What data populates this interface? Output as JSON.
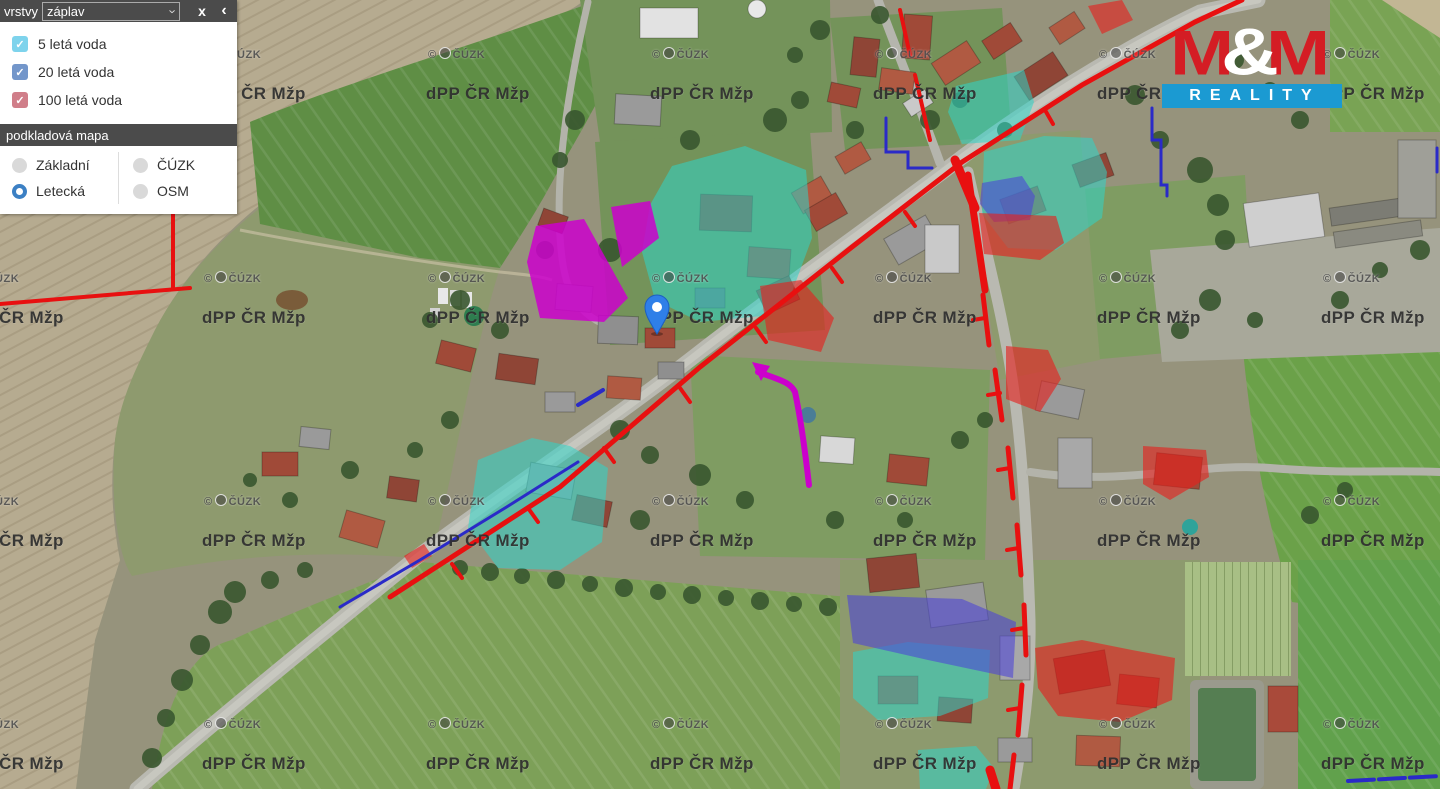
{
  "panel": {
    "layers_label": "vrstvy",
    "layers_select_value": "záplav",
    "close_label": "x",
    "collapse_label": "‹",
    "checkboxes": [
      {
        "label": "5 letá voda",
        "color": "#7ed3ec",
        "checked": true
      },
      {
        "label": "20 letá voda",
        "color": "#7396ca",
        "checked": true
      },
      {
        "label": "100 letá voda",
        "color": "#d07e89",
        "checked": true
      }
    ],
    "basemap_label": "podkladová mapa",
    "basemap_options": [
      {
        "label": "Základní",
        "selected": false
      },
      {
        "label": "ČÚZK",
        "selected": false
      },
      {
        "label": "Letecká",
        "selected": true
      },
      {
        "label": "OSM",
        "selected": false
      }
    ]
  },
  "logo": {
    "m_left": "M",
    "amp": "&",
    "m_right": "M",
    "bottom": "REALITY"
  },
  "watermarks": {
    "tile_text": "dPP ČR Mžp",
    "copyright_text_prefix": "©",
    "copyright_text": "ČÚZK",
    "cols": [
      -40,
      202,
      426,
      650,
      873,
      1097,
      1321
    ],
    "rows": [
      84,
      308,
      531,
      754
    ],
    "copyright_row_offset": -37
  },
  "map": {
    "marker": {
      "x": 657,
      "y": 334
    }
  },
  "colors": {
    "flood5": "#2fd6c8",
    "flood20": "#4b44d8",
    "flood100": "#e5201d",
    "flood_other": "#cc00cc",
    "util_red": "#e81010",
    "util_blue": "#2a2ac8",
    "panel_dark": "#4b4b4b",
    "radio_blue": "#3c80c4",
    "logo_red": "#d41d24",
    "logo_blue": "#1b9ad2"
  }
}
